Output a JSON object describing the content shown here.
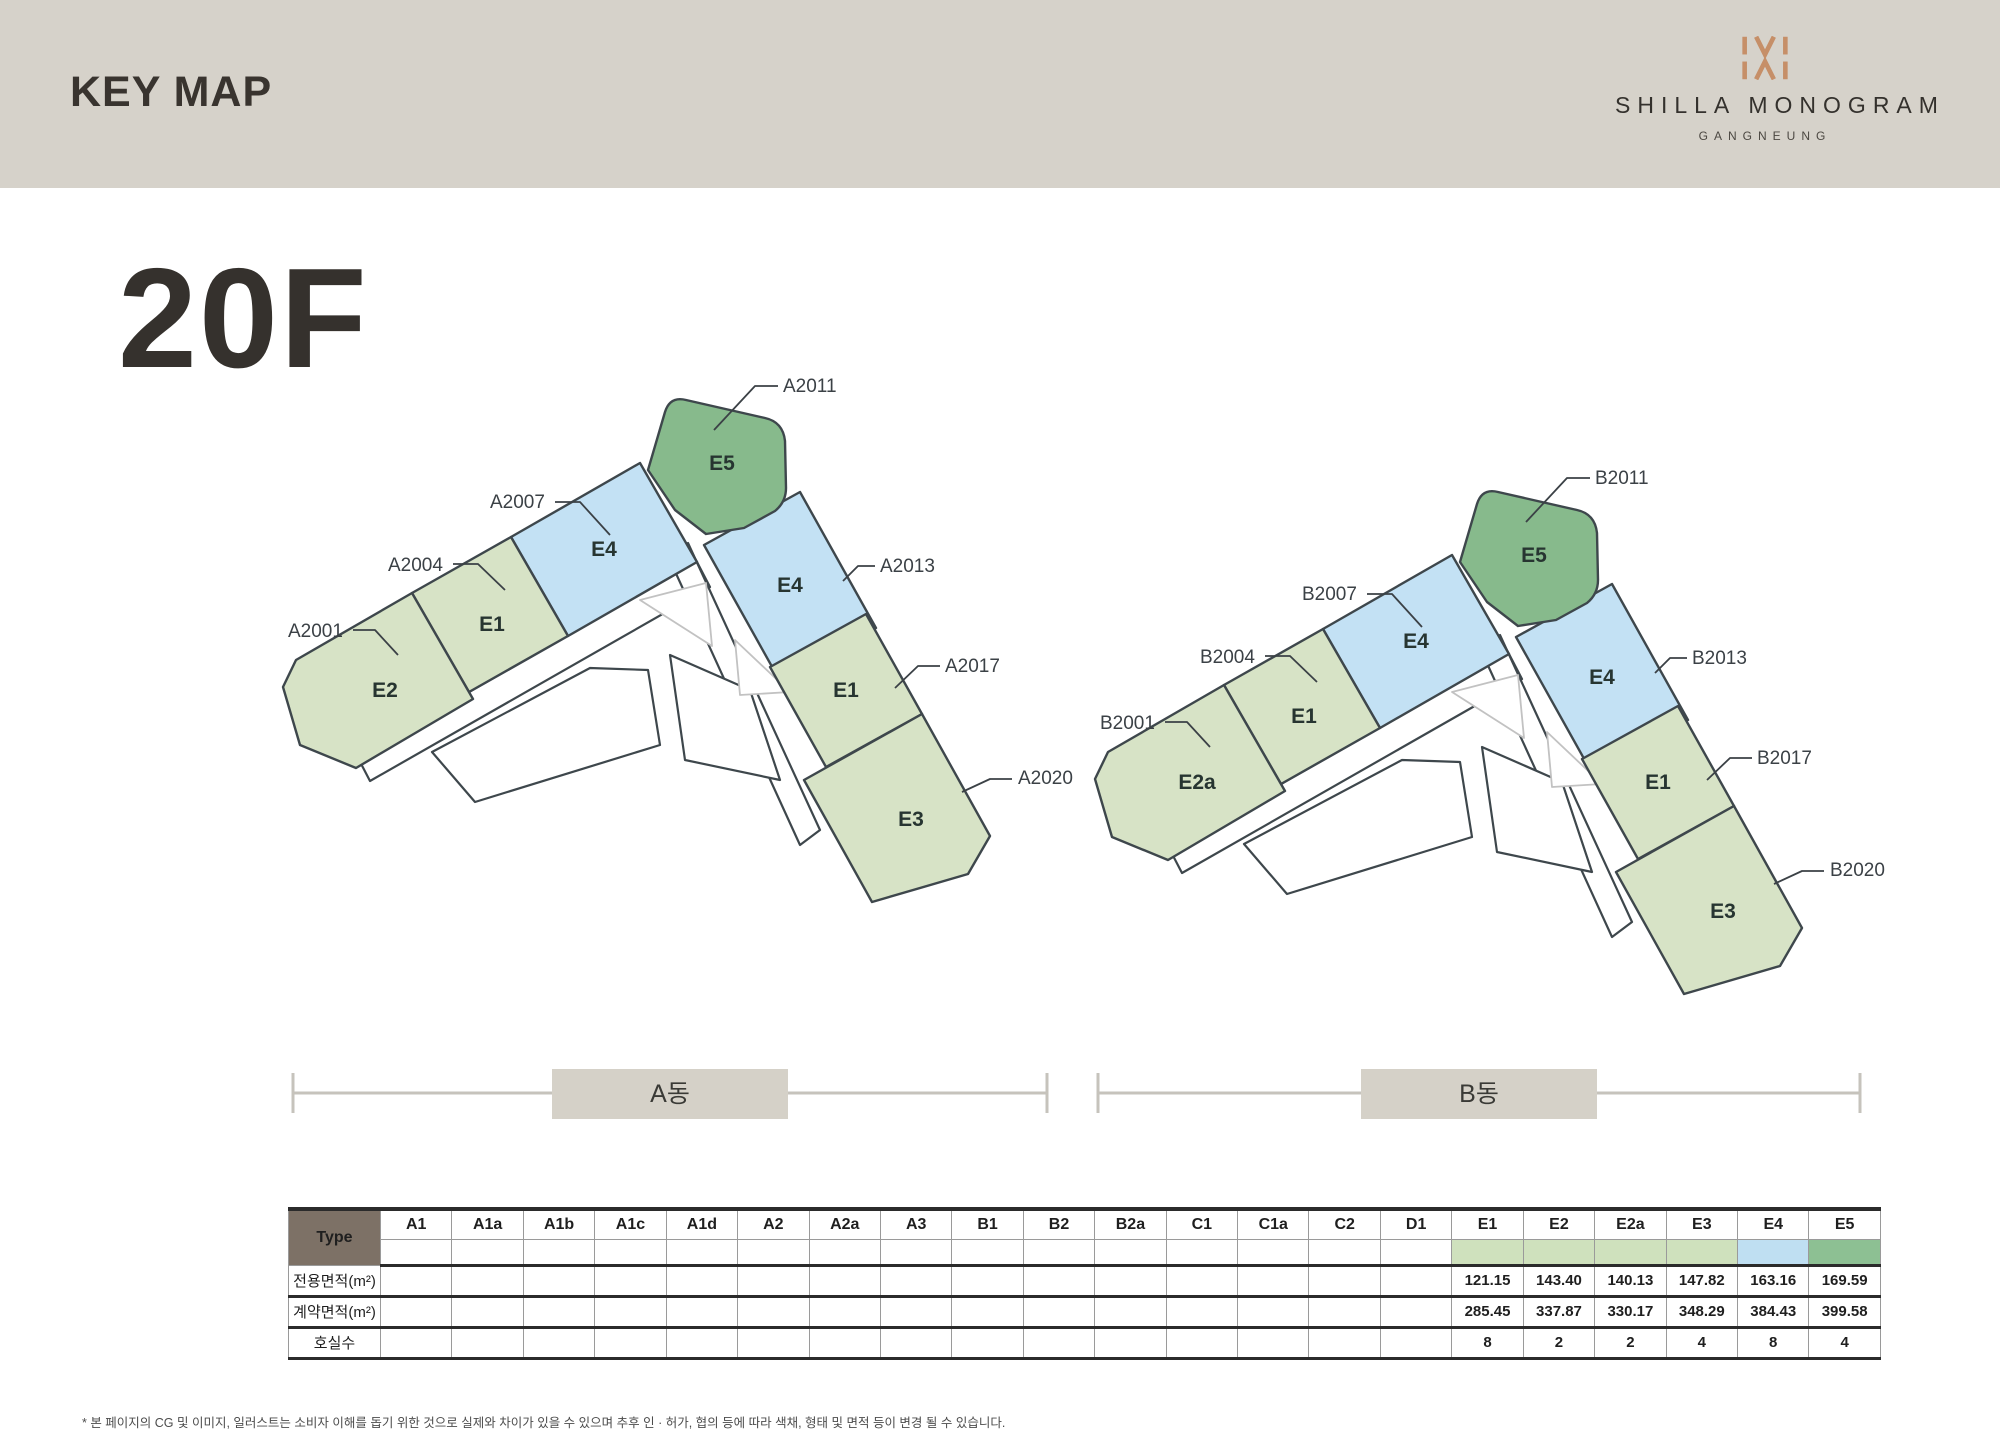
{
  "header": {
    "title": "KEY MAP",
    "brand_name": "SHILLA MONOGRAM",
    "brand_location": "GANGNEUNG"
  },
  "floor": {
    "label": "20F"
  },
  "colors": {
    "header_bg": "#d6d2ca",
    "unit_green_light": "#d7e3c6",
    "unit_blue": "#c3e1f4",
    "unit_green_dark": "#87ba8c",
    "outline_dark": "#3e474c",
    "outline_light": "#c2c2c2",
    "brand_copper": "#c68f68",
    "table_corner_bg": "#7d7166",
    "swatch_green": "#cfe1bd",
    "swatch_blue": "#bfdff2",
    "swatch_dark_green": "#8dc093"
  },
  "plans": {
    "a": {
      "band_label": "A동",
      "units": {
        "u1": "E2",
        "u2": "E1",
        "u3": "E4",
        "u4": "E5",
        "u5": "E4",
        "u6": "E1",
        "u7": "E3"
      },
      "callouts": {
        "c1": "A2001",
        "c2": "A2004",
        "c3": "A2007",
        "c4": "A2011",
        "c5": "A2013",
        "c6": "A2017",
        "c7": "A2020"
      }
    },
    "b": {
      "band_label": "B동",
      "units": {
        "u1": "E2a",
        "u2": "E1",
        "u3": "E4",
        "u4": "E5",
        "u5": "E4",
        "u6": "E1",
        "u7": "E3"
      },
      "callouts": {
        "c1": "B2001",
        "c2": "B2004",
        "c3": "B2007",
        "c4": "B2011",
        "c5": "B2013",
        "c6": "B2017",
        "c7": "B2020"
      }
    }
  },
  "table": {
    "corner": "Type",
    "columns": [
      "A1",
      "A1a",
      "A1b",
      "A1c",
      "A1d",
      "A2",
      "A2a",
      "A3",
      "B1",
      "B2",
      "B2a",
      "C1",
      "C1a",
      "C2",
      "D1",
      "E1",
      "E2",
      "E2a",
      "E3",
      "E4",
      "E5"
    ],
    "swatches": {
      "E1": "#cfe1bd",
      "E2": "#cfe1bd",
      "E2a": "#cfe1bd",
      "E3": "#cfe1bd",
      "E4": "#bfdff2",
      "E5": "#8dc093"
    },
    "rows": [
      {
        "label": "전용면적(m²)",
        "values": {
          "E1": "121.15",
          "E2": "143.40",
          "E2a": "140.13",
          "E3": "147.82",
          "E4": "163.16",
          "E5": "169.59"
        }
      },
      {
        "label": "계약면적(m²)",
        "values": {
          "E1": "285.45",
          "E2": "337.87",
          "E2a": "330.17",
          "E3": "348.29",
          "E4": "384.43",
          "E5": "399.58"
        }
      },
      {
        "label": "호실수",
        "values": {
          "E1": "8",
          "E2": "2",
          "E2a": "2",
          "E3": "4",
          "E4": "8",
          "E5": "4"
        }
      }
    ]
  },
  "footnote": "* 본 페이지의 CG 및 이미지, 일러스트는 소비자 이해를 돕기 위한 것으로 실제와 차이가 있을 수 있으며 추후 인 · 허가, 협의 등에 따라 색채, 형태 및 면적 등이 변경 될 수 있습니다."
}
